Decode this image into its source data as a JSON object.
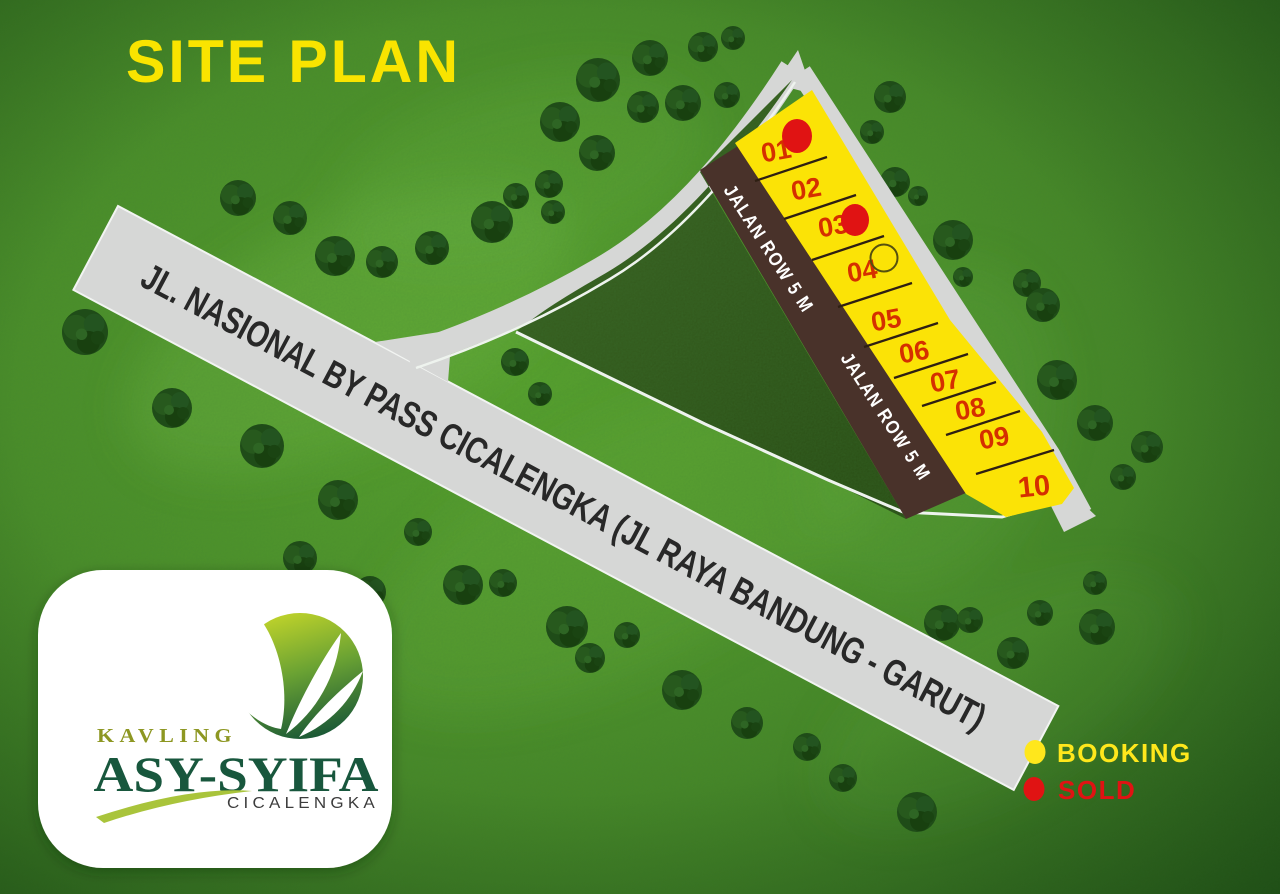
{
  "title": "SITE PLAN",
  "roads": {
    "main": {
      "label": "JL. NASIONAL BY PASS CICALENGKA (JL RAYA BANDUNG - GARUT)"
    },
    "internal": {
      "label": "JALAN ROW 5 M"
    }
  },
  "plots": [
    {
      "number": "01",
      "status": "sold"
    },
    {
      "number": "02",
      "status": "available"
    },
    {
      "number": "03",
      "status": "sold"
    },
    {
      "number": "04",
      "status": "booking"
    },
    {
      "number": "05",
      "status": "available"
    },
    {
      "number": "06",
      "status": "available"
    },
    {
      "number": "07",
      "status": "available"
    },
    {
      "number": "08",
      "status": "available"
    },
    {
      "number": "09",
      "status": "available"
    },
    {
      "number": "10",
      "status": "available"
    }
  ],
  "legend": {
    "booking": {
      "label": "BOOKING",
      "color": "#ffe71c"
    },
    "sold": {
      "label": "SOLD",
      "color": "#e01313"
    }
  },
  "logo": {
    "kavling": "KAVLING",
    "name": "ASY-SYIFA",
    "city": "CICALENGKA"
  },
  "colors": {
    "title_yellow": "#f9e400",
    "plot_fill": "#fbe306",
    "plot_number_red": "#d52f00",
    "internal_road_brown": "#49322a",
    "main_road_gray": "#d6d7d6",
    "field_dark_green": "#33541c",
    "grass_green": "#4f9c2c"
  }
}
